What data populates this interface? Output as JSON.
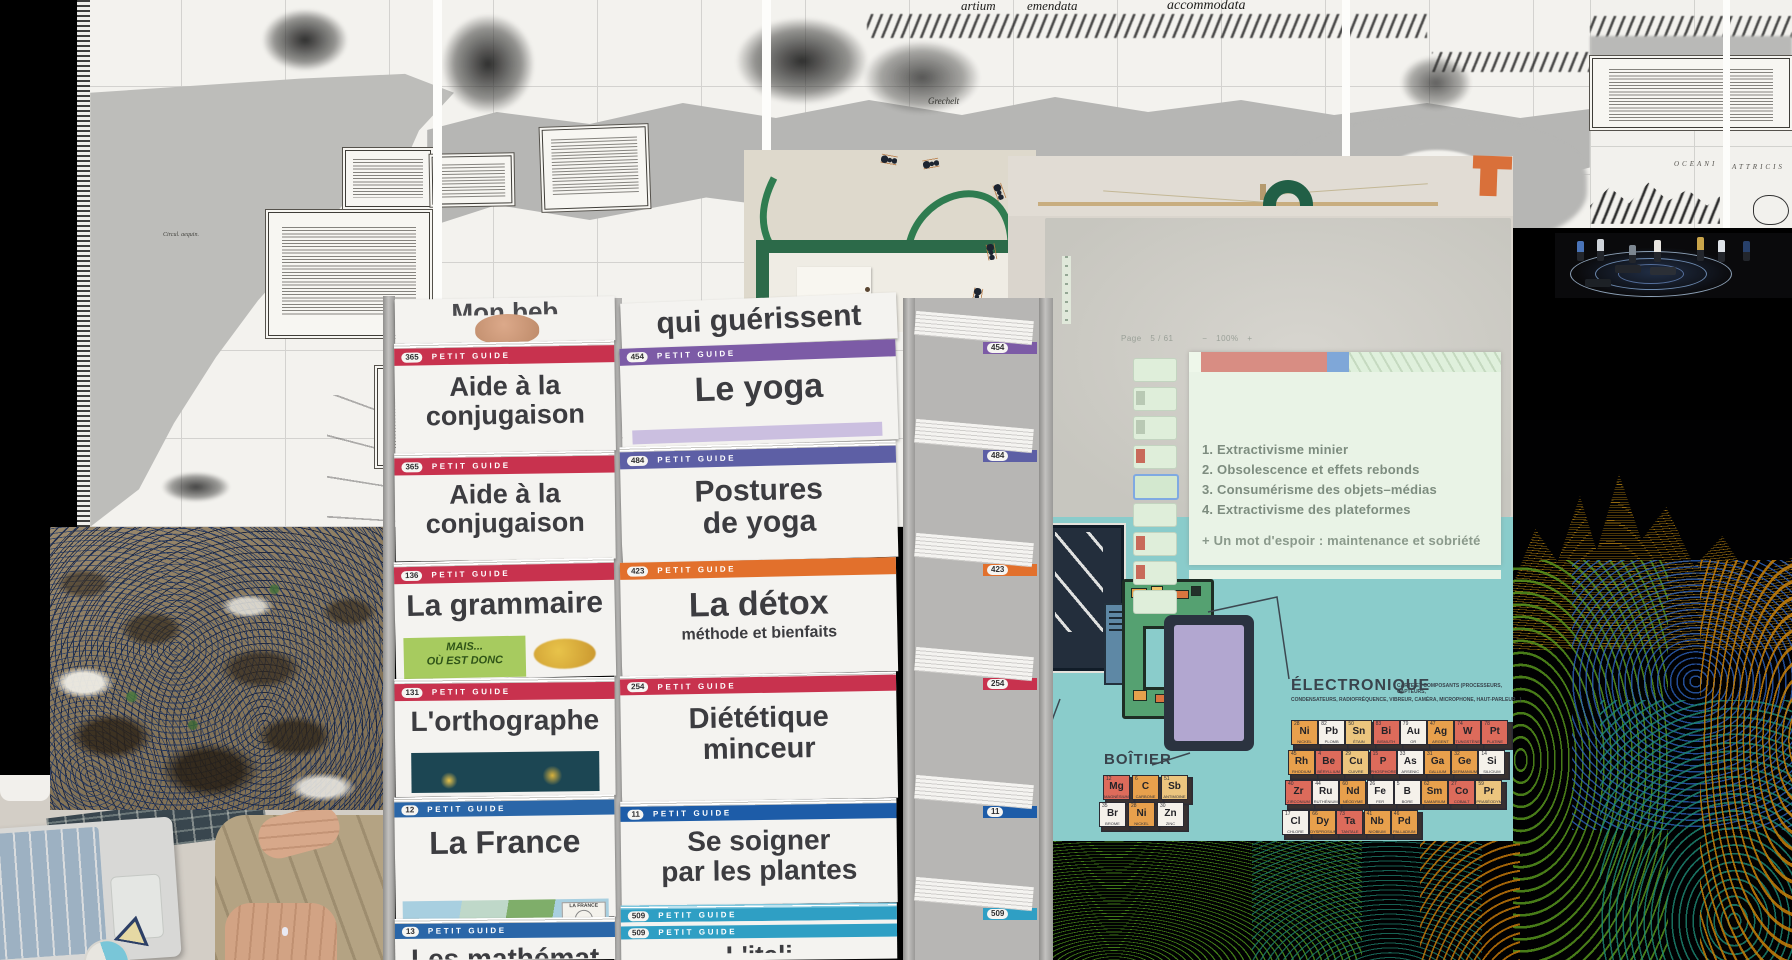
{
  "map": {
    "sheet_title_fragment_left": "artium",
    "sheet_title_fragment_mid": "emendata",
    "sheet_title_fragment_right": "accommodata",
    "sea_label": "Grechelt",
    "ocean_word_1": "OCEANI",
    "ocean_word_2": "ATTRICIS",
    "equator_label": "Circul. aequin."
  },
  "rack": {
    "series_label": "PETIT GUIDE",
    "left": [
      {
        "title_partial": "Mon beb"
      },
      {
        "num": "365",
        "title": "Aide à la\nconjugaison",
        "band": "#c8324e"
      },
      {
        "num": "365",
        "title": "Aide à la\nconjugaison",
        "band": "#c8324e"
      },
      {
        "num": "136",
        "title": "La grammaire",
        "band": "#c8324e",
        "sticky": "MAIS...\nOÙ EST DONC"
      },
      {
        "num": "131",
        "title": "L'orthographe",
        "band": "#c8324e"
      },
      {
        "num": "12",
        "title": "La France",
        "band": "#2a66a8",
        "inset_label": "LA FRANCE"
      },
      {
        "num": "13",
        "title_partial": "Les mathémat",
        "band": "#2a66a8"
      }
    ],
    "right": [
      {
        "title_partial": "qui guérissent"
      },
      {
        "num": "454",
        "title": "Le yoga",
        "band": "#7c5ba6"
      },
      {
        "num": "484",
        "title": "Postures\nde yoga",
        "band": "#5d5fa5"
      },
      {
        "num": "423",
        "title": "La détox",
        "subtitle": "méthode et bienfaits",
        "band": "#e2702c"
      },
      {
        "num": "254",
        "title": "Diététique\nminceur",
        "band": "#c8324e"
      },
      {
        "num": "11",
        "title": "Se soigner\npar les plantes",
        "band": "#1d5ca8"
      },
      {
        "num": "509",
        "title_partial": "L'itali",
        "band": "#2f9fc4"
      }
    ],
    "spines": [
      {
        "num": "454",
        "color": "#7c5ba6"
      },
      {
        "num": "484",
        "color": "#5d5fa5"
      },
      {
        "num": "423",
        "color": "#e2702c"
      },
      {
        "num": "254",
        "color": "#c8324e"
      },
      {
        "num": "11",
        "color": "#1d5ca8"
      },
      {
        "num": "509",
        "color": "#2f9fc4"
      }
    ]
  },
  "presentation": {
    "toolbar": {
      "page_label": "Page",
      "page_current": "5",
      "slash": "/",
      "page_total": "61",
      "zoom_out": "−",
      "zoom_value": "100%",
      "zoom_in": "+"
    },
    "slide": {
      "items": [
        "1.  Extractivisme minier",
        "2.  Obsolescence et effets rebonds",
        "3.  Consumérisme des objets–médias",
        "4.  Extractivisme des plateformes"
      ],
      "footer": "+ Un mot d'espoir : maintenance et sobriété",
      "header_red": "#d88d83",
      "header_blue": "#7fa7d8"
    }
  },
  "electronics": {
    "background": "#8acccb",
    "boitier_label": "BOÎTIER",
    "electronique_label": "ÉLECTRONIQUE",
    "caption_line_1": "CARTE ET COMPOSANTS (PROCESSEURS, CAPTEURS,",
    "caption_line_2": "CONDENSATEURS, RADIOFRÉQUENCE, VIBREUR, CAMÉRA, MICROPHONE, HAUT-PARLEUR...)",
    "boitier_elements": [
      {
        "n": "12",
        "sym": "Mg",
        "name": "MAGNÉSIUM",
        "color": "#dd6b5b"
      },
      {
        "n": "6",
        "sym": "C",
        "name": "CARBONE",
        "color": "#e8a04c"
      },
      {
        "n": "51",
        "sym": "Sb",
        "name": "ANTIMOINE",
        "color": "#ecc57e"
      },
      {
        "n": "35",
        "sym": "Br",
        "name": "BROME",
        "color": "#f5f1ea"
      },
      {
        "n": "28",
        "sym": "Ni",
        "name": "NICKEL",
        "color": "#e8a04c"
      },
      {
        "n": "30",
        "sym": "Zn",
        "name": "ZINC",
        "color": "#f5f1ea"
      }
    ],
    "element_rows": [
      [
        {
          "n": "28",
          "sym": "Ni",
          "name": "NICKEL",
          "color": "#e8a04c"
        },
        {
          "n": "82",
          "sym": "Pb",
          "name": "PLOMB",
          "color": "#f5f1ea"
        },
        {
          "n": "50",
          "sym": "Sn",
          "name": "ÉTAIN",
          "color": "#ecc57e"
        },
        {
          "n": "83",
          "sym": "Bi",
          "name": "BISMUTH",
          "color": "#dd6b5b"
        },
        {
          "n": "79",
          "sym": "Au",
          "name": "OR",
          "color": "#f5f1ea"
        },
        {
          "n": "47",
          "sym": "Ag",
          "name": "ARGENT",
          "color": "#e8a04c"
        },
        {
          "n": "74",
          "sym": "W",
          "name": "TUNGSTÈNE",
          "color": "#dd6b5b"
        },
        {
          "n": "78",
          "sym": "Pt",
          "name": "PLATINE",
          "color": "#dd6b5b"
        }
      ],
      [
        {
          "n": "45",
          "sym": "Rh",
          "name": "RHODIUM",
          "color": "#e8a04c"
        },
        {
          "n": "4",
          "sym": "Be",
          "name": "BÉRYLLIUM",
          "color": "#dd6b5b"
        },
        {
          "n": "29",
          "sym": "Cu",
          "name": "CUIVRE",
          "color": "#ecc57e"
        },
        {
          "n": "15",
          "sym": "P",
          "name": "PHOSPHORE",
          "color": "#dd6b5b"
        },
        {
          "n": "33",
          "sym": "As",
          "name": "ARSENIC",
          "color": "#f5f1ea"
        },
        {
          "n": "31",
          "sym": "Ga",
          "name": "GALLIUM",
          "color": "#e8a04c"
        },
        {
          "n": "32",
          "sym": "Ge",
          "name": "GERMANIUM",
          "color": "#e8a04c"
        },
        {
          "n": "14",
          "sym": "Si",
          "name": "SILICIUM",
          "color": "#f5f1ea"
        }
      ],
      [
        {
          "n": "40",
          "sym": "Zr",
          "name": "ZIRCONIUM",
          "color": "#dd6b5b"
        },
        {
          "n": "44",
          "sym": "Ru",
          "name": "RUTHÉNIUM",
          "color": "#f5f1ea"
        },
        {
          "n": "60",
          "sym": "Nd",
          "name": "NÉODYME",
          "color": "#e8a04c"
        },
        {
          "n": "26",
          "sym": "Fe",
          "name": "FER",
          "color": "#f5f1ea"
        },
        {
          "n": "5",
          "sym": "B",
          "name": "BORE",
          "color": "#f5f1ea"
        },
        {
          "n": "62",
          "sym": "Sm",
          "name": "SAMARIUM",
          "color": "#e8a04c"
        },
        {
          "n": "27",
          "sym": "Co",
          "name": "COBALT",
          "color": "#dd6b5b"
        },
        {
          "n": "59",
          "sym": "Pr",
          "name": "PRASÉODYME",
          "color": "#ecc57e"
        }
      ],
      [
        {
          "n": "17",
          "sym": "Cl",
          "name": "CHLORE",
          "color": "#f5f1ea"
        },
        {
          "n": "66",
          "sym": "Dy",
          "name": "DYSPROSIUM",
          "color": "#e8a04c"
        },
        {
          "n": "73",
          "sym": "Ta",
          "name": "TANTALE",
          "color": "#dd6b5b"
        },
        {
          "n": "41",
          "sym": "Nb",
          "name": "NIOBIUM",
          "color": "#e8a04c"
        },
        {
          "n": "46",
          "sym": "Pd",
          "name": "PALLADIUM",
          "color": "#e8a04c"
        }
      ]
    ]
  },
  "palette": {
    "contour_amber": "#b07d12",
    "contour_green": "#5a9b1e",
    "contour_blue": "#2f66c4",
    "contour_teal": "#1e8a76",
    "contour_orange": "#c77f08",
    "petit_guide_red": "#c8324e",
    "teal_background": "#8acccb",
    "orange_logo": "#d9703a"
  }
}
